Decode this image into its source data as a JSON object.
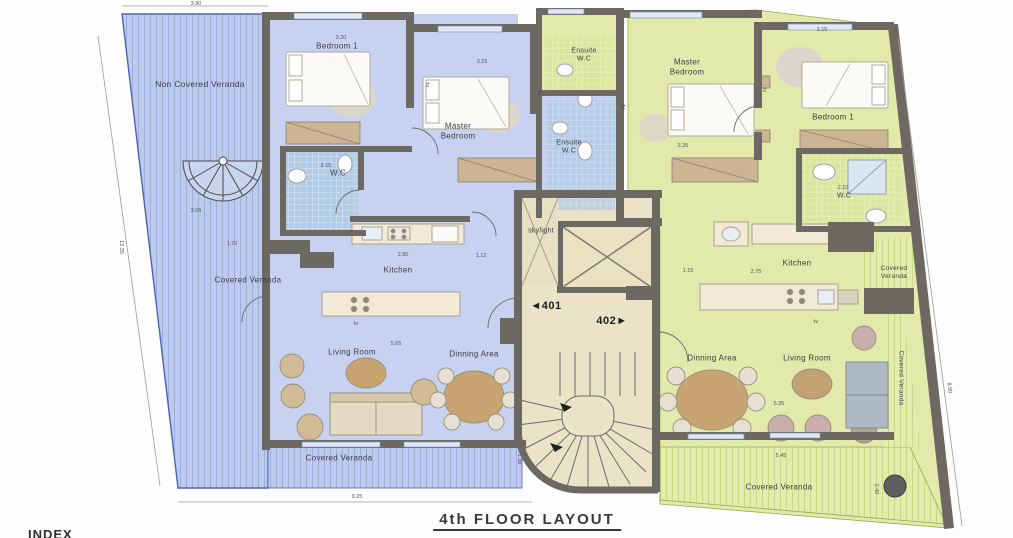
{
  "title": "4th FLOOR LAYOUT",
  "index_label": "INDEX",
  "units": {
    "left": "◄401",
    "right": "402►"
  },
  "rooms": {
    "non_covered_veranda": "Non Covered Veranda",
    "bedroom1_left": "Bedroom 1",
    "master_left": "Master\nBedroom",
    "wc_left": "W.C",
    "ensuite_left": "Ensuite\nW.C",
    "ensuite_right": "Ensuite\nW.C",
    "master_right": "Master\nBedroom",
    "bedroom1_right": "Bedroom 1",
    "wc_right": "W.C",
    "skylight": "skylight",
    "kitchen_left": "Kitchen",
    "kitchen_right": "Kitchen",
    "living_left": "Living Room",
    "dinning_left": "Dinning Area",
    "dinning_right": "Dinning Area",
    "living_right": "Living Room",
    "covered_veranda_left_mid": "Covered Veranda",
    "covered_veranda_left_bottom": "Covered Veranda",
    "covered_veranda_right_small": "Covered\nVeranda",
    "covered_veranda_right_edge": "Covered Veranda",
    "covered_veranda_right_bottom": "Covered Veranda",
    "tv": "tv"
  },
  "dimensions": {
    "d390": "3.90",
    "d320": "3.20",
    "d315a": "3.15",
    "d315b": "3.15",
    "d335": "3.35",
    "d215": "2.15",
    "d210": "2.10",
    "d305": "3.05",
    "d170": "1.70",
    "d280": "2.80",
    "d112": "1.12",
    "d565": "5.65",
    "d130": "1.30",
    "d925": "9.25",
    "d535": "5.35",
    "d545": "5.45",
    "d115": "1.15",
    "d275": "2.75",
    "d1235": "12.35",
    "d240": "2.40",
    "d850": "8.50"
  },
  "colors": {
    "wall": "#6c6862",
    "blue_floor": "#c6d2ef",
    "blue_stripe": "#bdcaec",
    "green_floor": "#e1eaaa",
    "green_stripe": "#e3ecae",
    "core_floor": "#eae3c8",
    "tile_blue": "#aecbe8",
    "wood": "#c8a473",
    "wardrobe": "#cdb493",
    "window": "#dfe9f7"
  }
}
